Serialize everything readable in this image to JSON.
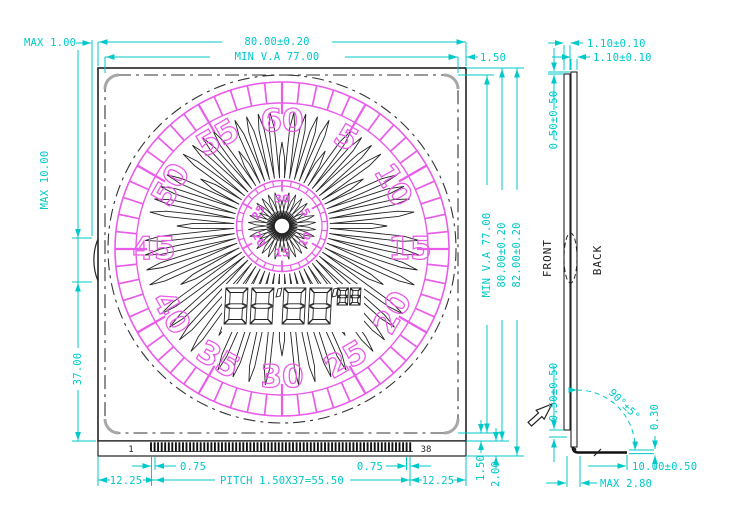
{
  "dims": {
    "max1": "MAX 1.00",
    "width": "80.00±0.20",
    "va_w": "MIN V.A 77.00",
    "margin_top_right": "1.50",
    "max10": "MAX 10.00",
    "d37": "37.00",
    "va_h": "MIN V.A 77.00",
    "height": "80.00±0.20",
    "total_h": "82.00±0.20",
    "va_bottom": "1.50",
    "strip_h": "2.00",
    "half_pitch_left": "0.75",
    "half_pitch_right": "0.75",
    "margin_pin_left": "12.25",
    "margin_pin_right": "12.25",
    "pitch": "PITCH 1.50X37=55.50"
  },
  "side": {
    "glass1": "1.10±0.10",
    "glass2": "1.10±0.10",
    "off_top": "0.50±0.50",
    "off_bot": "0.50±0.50",
    "angle": "90°±5°",
    "pin_t": "0.30",
    "pin_len": "10.00±0.50",
    "max28": "MAX 2.80",
    "front": "FRONT",
    "back": "BACK"
  },
  "pins": {
    "first": "1",
    "last": "38"
  },
  "dial": {
    "outer": [
      {
        "t": "60",
        "a": 0,
        "r": 0
      },
      {
        "t": "5",
        "a": 30,
        "r": 30
      },
      {
        "t": "10",
        "a": 60,
        "r": 60
      },
      {
        "t": "15",
        "a": 90,
        "r": 0
      },
      {
        "t": "20",
        "a": 120,
        "r": -60
      },
      {
        "t": "25",
        "a": 150,
        "r": -30
      },
      {
        "t": "30",
        "a": 180,
        "r": 0
      },
      {
        "t": "35",
        "a": 210,
        "r": 30
      },
      {
        "t": "40",
        "a": 240,
        "r": 60
      },
      {
        "t": "45",
        "a": 270,
        "r": 0
      },
      {
        "t": "50",
        "a": 300,
        "r": -60
      },
      {
        "t": "55",
        "a": 330,
        "r": -30
      }
    ],
    "inner": [
      {
        "t": "30",
        "a": 0,
        "r": 0
      },
      {
        "t": "5",
        "a": 60,
        "r": 60
      },
      {
        "t": "10",
        "a": 120,
        "r": -60
      },
      {
        "t": "15",
        "a": 180,
        "r": 0
      },
      {
        "t": "20",
        "a": 240,
        "r": 60
      },
      {
        "t": "25",
        "a": 300,
        "r": -60
      }
    ]
  },
  "display": {
    "large": [
      "8",
      "8",
      "8",
      "8"
    ],
    "small": [
      "8",
      "8"
    ]
  },
  "colors": {
    "dim": "#00c9c9",
    "art": "#e95ce9",
    "line": "#222222"
  }
}
